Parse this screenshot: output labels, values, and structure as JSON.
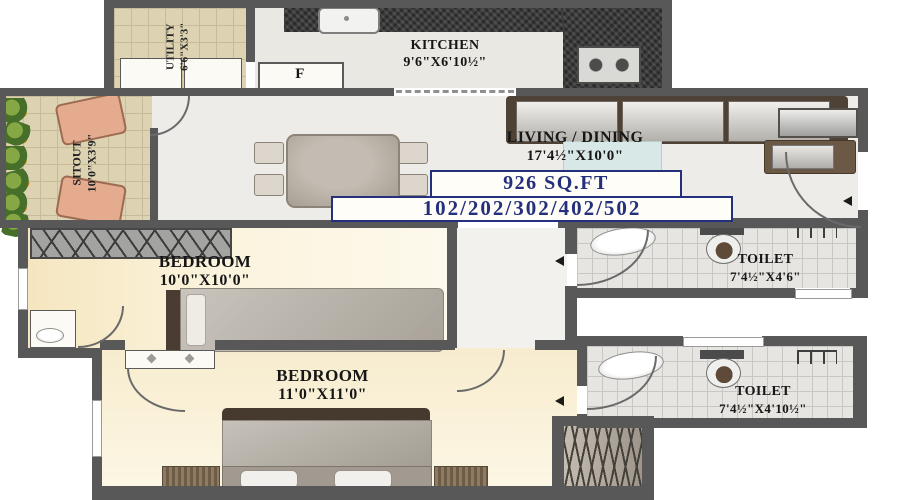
{
  "plan": {
    "area_label": "926 SQ.FT",
    "units_label": "102/202/302/402/502"
  },
  "rooms": {
    "kitchen": {
      "name": "KITCHEN",
      "dims": "9'6\"X6'10½\""
    },
    "utility": {
      "name": "UTILITY",
      "dims": "6'6\"X3'3\""
    },
    "sitout": {
      "name": "SITOUT",
      "dims": "10'0\"X3'9\""
    },
    "living": {
      "name": "LIVING / DINING",
      "dims": "17'4½\"X10'0\""
    },
    "bedroom1": {
      "name": "BEDROOM",
      "dims": "10'0\"X10'0\""
    },
    "bedroom2": {
      "name": "BEDROOM",
      "dims": "11'0\"X11'0\""
    },
    "toilet1": {
      "name": "TOILET",
      "dims": "7'4½\"X4'6\""
    },
    "toilet2": {
      "name": "TOILET",
      "dims": "7'4½\"X4'10½\""
    }
  },
  "labels": {
    "fridge": "F"
  },
  "colors": {
    "wall": "#585858",
    "accent_navy": "#25307d",
    "tile_beige": "#ddd2b2",
    "floor_bedroom": "#f8edd0",
    "counter_granite": "#3d3d3d"
  }
}
